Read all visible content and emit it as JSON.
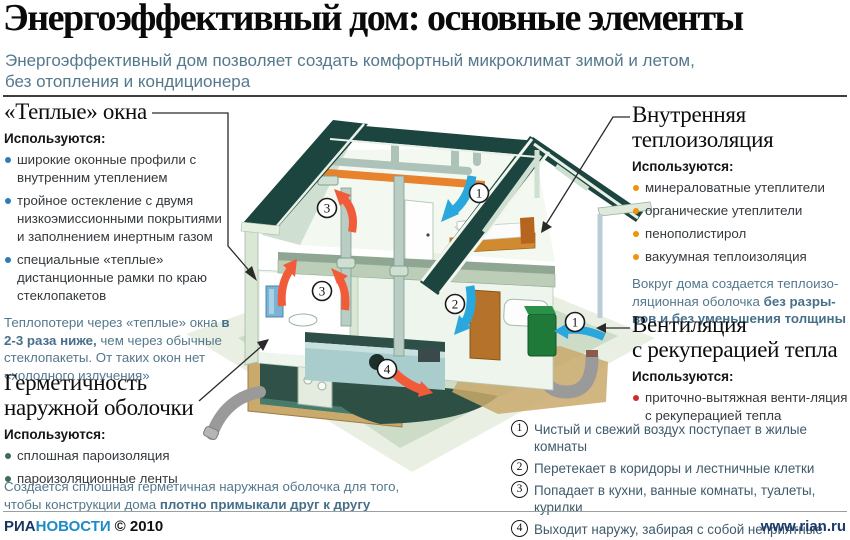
{
  "header": {
    "title": "Энергоэффективный дом: основные элементы",
    "subtitle_line1": "Энергоэффективный дом позволяет создать комфортный микроклимат зимой и летом,",
    "subtitle_line2": "без отопления и кондиционера"
  },
  "sections": {
    "warm_windows": {
      "title": "«Теплые» окна",
      "uses_label": "Используются:",
      "bullets": [
        "широкие оконные профили с внутренним утеплением",
        "тройное остекление с двумя низкоэмиссионными покрытиями и заполнением инертным газом",
        "специальные «теплые» дистанционные рамки по краю стеклопакетов"
      ],
      "note_plain1": "Теплопотери через «теплые» окна ",
      "note_bold": "в 2-3 раза ниже,",
      "note_plain2": " чем через обычные стеклопакеты. От таких окон нет «холодного излучения»"
    },
    "sealing": {
      "title_line1": "Герметичность",
      "title_line2": "наружной оболочки",
      "uses_label": "Используются:",
      "bullets": [
        "сплошная пароизоляция",
        "пароизоляционные ленты"
      ],
      "note_plain": "Создается сплошная герметичная наружная оболочка для того, чтобы конструкции дома ",
      "note_bold": "плотно примыкали друг к другу"
    },
    "insulation": {
      "title_line1": "Внутренняя",
      "title_line2": "теплоизоляция",
      "uses_label": "Используются:",
      "bullets": [
        "минераловатные утеплители",
        "органические утеплители",
        "пенополистирол",
        "вакуумная теплоизоляция"
      ],
      "note_plain": "Вокруг дома создается теплоизо-ляционная оболочка ",
      "note_bold": "без разры-вов и без уменьшения толщины"
    },
    "ventilation": {
      "title_line1": "Вентиляция",
      "title_line2": "с рекуперацией тепла",
      "uses_label": "Используются:",
      "bullets": [
        "приточно-вытяжная венти-ляция с рекуперацией тепла"
      ]
    }
  },
  "airflow_steps": [
    {
      "num": "1",
      "text": "Чистый и свежий воздух поступает в жилые комнаты"
    },
    {
      "num": "2",
      "text": "Перетекает в коридоры и лестничные клетки"
    },
    {
      "num": "3",
      "text": "Попадает в кухни, ванные комнаты, туалеты, курилки"
    },
    {
      "num": "4",
      "text": "Выходит наружу, забирая с собой неприятные запахи"
    }
  ],
  "house": {
    "markers": {
      "m1": "1",
      "m2": "2",
      "m3": "3",
      "m4": "4"
    }
  },
  "footer": {
    "brand_ria": "РИА",
    "brand_novosti": "НОВОСТИ",
    "copyright": "© 2010",
    "site": "www.rian.ru"
  },
  "colors": {
    "subtitle": "#54788c",
    "bullet_blue": "#2e7bb5",
    "bullet_orange": "#f0930a",
    "bullet_red": "#d02c2c",
    "bullet_green": "#3d6b5d",
    "roof": "#1c4540",
    "insulation_strip": "#e8822c",
    "fresh_air_arrow": "#2aa7dd",
    "exhaust_arrow": "#f15b39",
    "vent_unit": "#1f7a3a",
    "brand_dark": "#16355f",
    "brand_light": "#1e8bc6"
  }
}
